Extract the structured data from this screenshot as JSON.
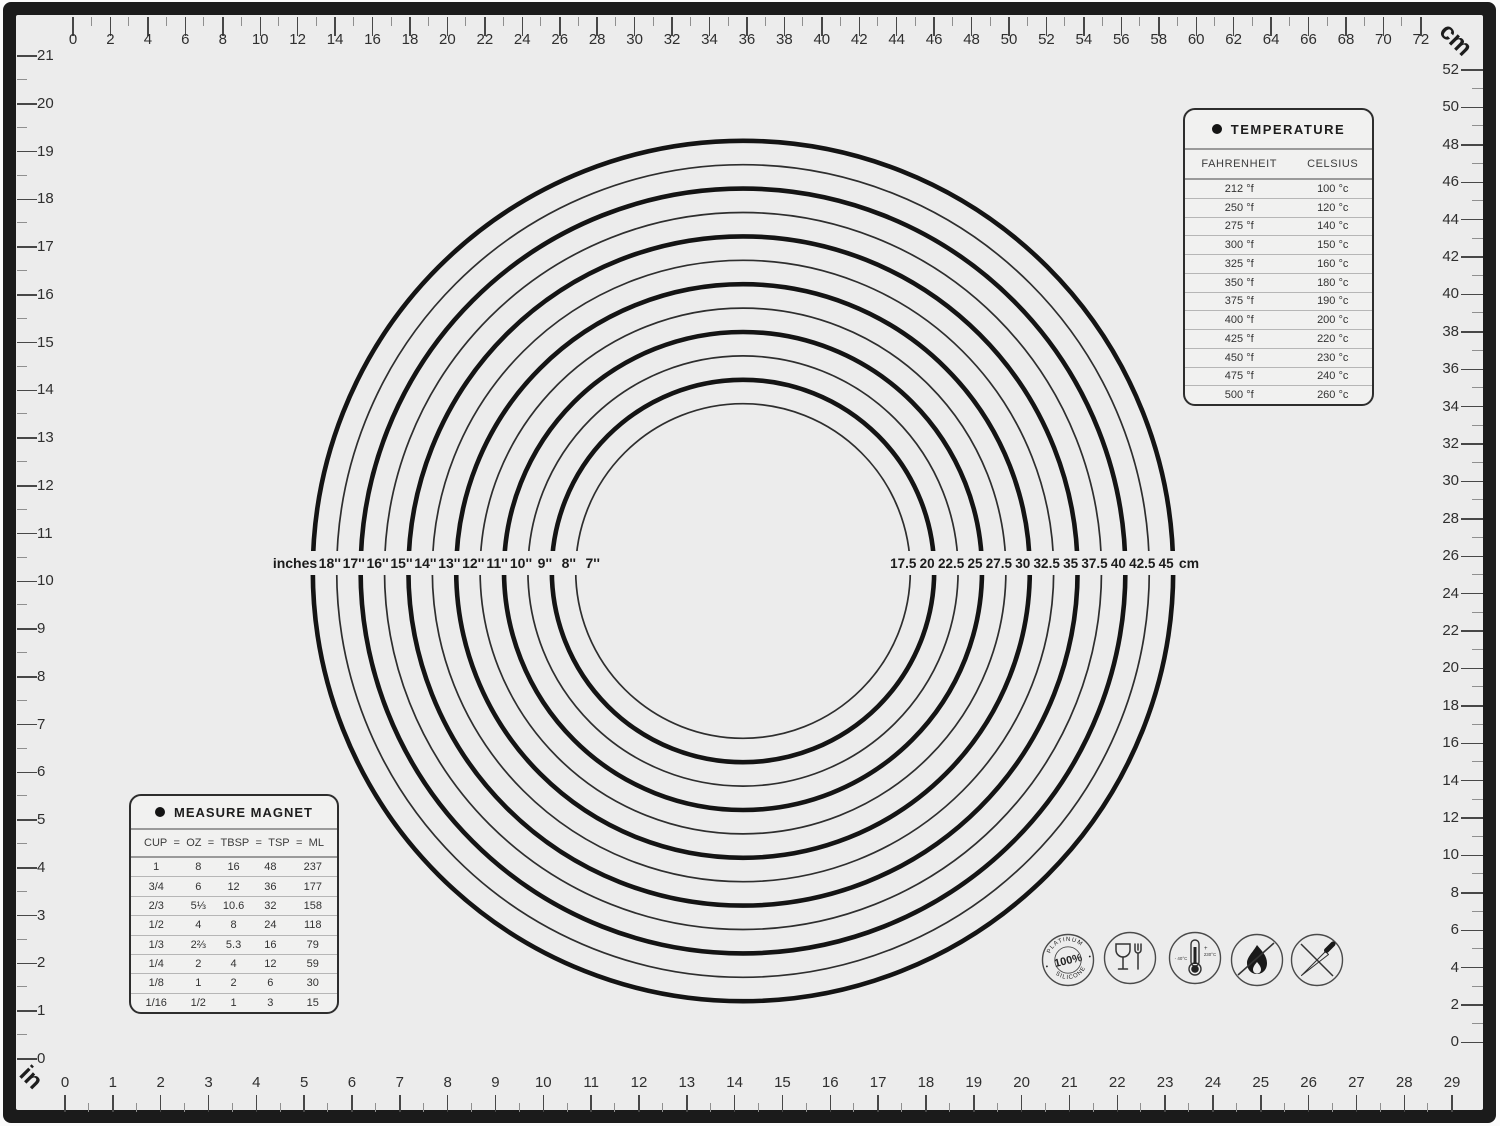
{
  "rulers": {
    "top": {
      "unit": "cm",
      "min": 0,
      "max": 72,
      "label_step": 2,
      "minor_step": 1
    },
    "right": {
      "unit": "cm",
      "min": 0,
      "max": 52,
      "label_step": 2,
      "minor_step": 1
    },
    "left": {
      "unit": "in",
      "min": 0,
      "max": 21,
      "label_step": 1,
      "minor_step": 0.5
    },
    "bottom": {
      "unit": "in",
      "min": 0,
      "max": 29,
      "label_step": 1,
      "minor_step": 0.5
    },
    "corner_unit_top_right": "cm",
    "corner_unit_bottom_left": "in"
  },
  "circles": {
    "left_axis_label": "inches",
    "right_axis_label": "cm",
    "rings": [
      {
        "inch_label": "18''",
        "cm_label": "45",
        "diameter_inches": 18,
        "thick": true
      },
      {
        "inch_label": "17''",
        "cm_label": "42.5",
        "diameter_inches": 17,
        "thick": false
      },
      {
        "inch_label": "16''",
        "cm_label": "40",
        "diameter_inches": 16,
        "thick": true
      },
      {
        "inch_label": "15''",
        "cm_label": "37.5",
        "diameter_inches": 15,
        "thick": false
      },
      {
        "inch_label": "14''",
        "cm_label": "35",
        "diameter_inches": 14,
        "thick": true
      },
      {
        "inch_label": "13''",
        "cm_label": "32.5",
        "diameter_inches": 13,
        "thick": false
      },
      {
        "inch_label": "12''",
        "cm_label": "30",
        "diameter_inches": 12,
        "thick": true
      },
      {
        "inch_label": "11''",
        "cm_label": "27.5",
        "diameter_inches": 11,
        "thick": false
      },
      {
        "inch_label": "10''",
        "cm_label": "25",
        "diameter_inches": 10,
        "thick": true
      },
      {
        "inch_label": "9''",
        "cm_label": "22.5",
        "diameter_inches": 9,
        "thick": false
      },
      {
        "inch_label": "8''",
        "cm_label": "20",
        "diameter_inches": 8,
        "thick": true
      },
      {
        "inch_label": "7''",
        "cm_label": "17.5",
        "diameter_inches": 7,
        "thick": false
      }
    ]
  },
  "temperature_table": {
    "title": "TEMPERATURE",
    "columns": [
      "FAHRENHEIT",
      "CELSIUS"
    ],
    "rows": [
      [
        "212 °f",
        "100 °c"
      ],
      [
        "250 °f",
        "120 °c"
      ],
      [
        "275 °f",
        "140 °c"
      ],
      [
        "300 °f",
        "150 °c"
      ],
      [
        "325 °f",
        "160 °c"
      ],
      [
        "350 °f",
        "180 °c"
      ],
      [
        "375 °f",
        "190 °c"
      ],
      [
        "400 °f",
        "200 °c"
      ],
      [
        "425 °f",
        "220 °c"
      ],
      [
        "450 °f",
        "230 °c"
      ],
      [
        "475 °f",
        "240 °c"
      ],
      [
        "500 °f",
        "260 °c"
      ]
    ]
  },
  "measure_table": {
    "title": "MEASURE MAGNET",
    "columns": [
      "CUP",
      "OZ",
      "TBSP",
      "TSP",
      "ML"
    ],
    "separator": "=",
    "rows": [
      [
        "1",
        "8",
        "16",
        "48",
        "237"
      ],
      [
        "3/4",
        "6",
        "12",
        "36",
        "177"
      ],
      [
        "2/3",
        "5⅓",
        "10.6",
        "32",
        "158"
      ],
      [
        "1/2",
        "4",
        "8",
        "24",
        "118"
      ],
      [
        "1/3",
        "2⅔",
        "5.3",
        "16",
        "79"
      ],
      [
        "1/4",
        "2",
        "4",
        "12",
        "59"
      ],
      [
        "1/8",
        "1",
        "2",
        "6",
        "30"
      ],
      [
        "1/16",
        "1/2",
        "1",
        "3",
        "15"
      ]
    ]
  },
  "icons": {
    "platinum_badge": {
      "top": "PLATINUM",
      "center": "100%",
      "bottom": "SILICONE"
    },
    "temperature_range": {
      "min": "- 40°C",
      "plus": "+",
      "max": "230°C"
    }
  },
  "colors": {
    "mat_background": "#ececec",
    "frame": "#1b1b1b",
    "ring_thick": "#141414",
    "ring_thin": "#2e2e2e"
  }
}
